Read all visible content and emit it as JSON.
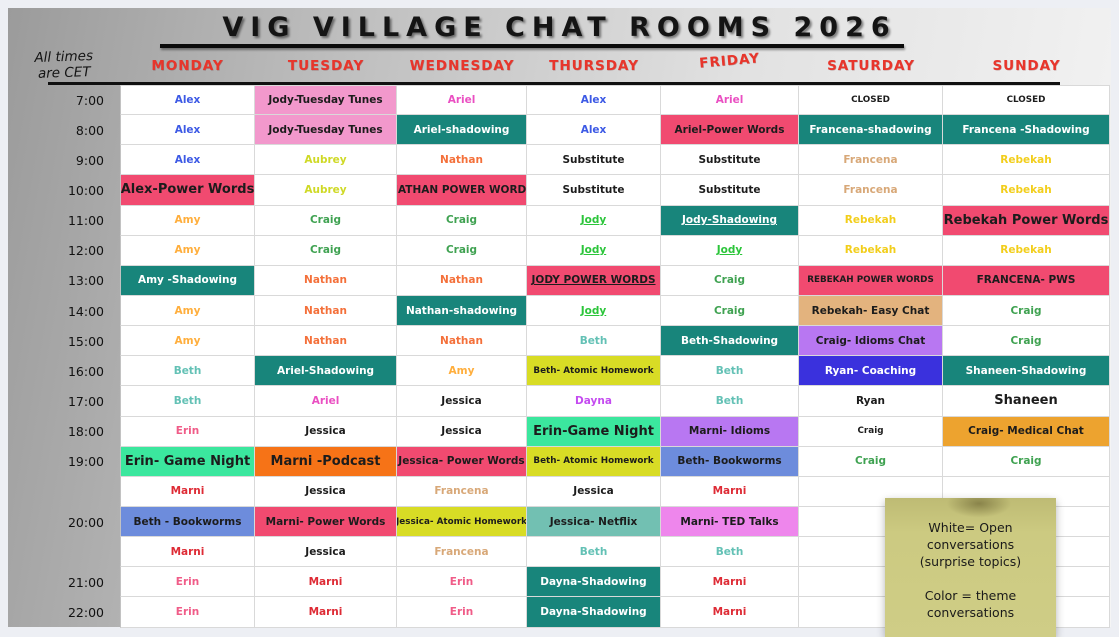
{
  "title": "VIG VILLAGE CHAT ROOMS 2026",
  "subtitle": "All times are CET",
  "days": [
    "MONDAY",
    "TUESDAY",
    "WEDNESDAY",
    "THURSDAY",
    "FRIDAY",
    "SATURDAY",
    "SUNDAY"
  ],
  "legend_note": {
    "lines": [
      "White= Open",
      "conversations",
      "(surprise topics)",
      "",
      "Color = theme",
      "conversations"
    ]
  },
  "palette": {
    "fg": {
      "black": "#1C1C1C",
      "white": "#FFFFFF",
      "blue": "#3D5AE5",
      "amber": "#FFAE3C",
      "orange": "#F4703A",
      "tealName": "#63C1B5",
      "pink": "#F05C88",
      "red": "#DE2B35",
      "chartreuse": "#CFD926",
      "green": "#3FA251",
      "jodyGreen": "#2BC53A",
      "magenta": "#EA4FC2",
      "purple": "#C44BF0",
      "tan": "#D8A878",
      "gold": "#F2CE1B"
    },
    "bg": {
      "white": "#FFFFFF",
      "teal": "#18857B",
      "crimson": "#F14A70",
      "pink": "#F298CC",
      "mint": "#3BE79E",
      "periwinkle": "#6D8CDC",
      "orangeBg": "#F67317",
      "yellow": "#D8DC25",
      "seafoam": "#72C0B2",
      "violet": "#B877F2",
      "orchid": "#EE86EC",
      "tanBg": "#E3B37E",
      "blueBg": "#3A31DD",
      "amberBg": "#EDA32F"
    }
  },
  "rows": [
    {
      "time": "7:00",
      "cells": [
        {
          "t": "Alex",
          "fg": "blue"
        },
        {
          "t": "Jody-Tuesday Tunes",
          "bg": "pink"
        },
        {
          "t": "Ariel",
          "fg": "magenta"
        },
        {
          "t": "Alex",
          "fg": "blue"
        },
        {
          "t": "Ariel",
          "fg": "magenta"
        },
        {
          "t": "CLOSED",
          "sz": "sm"
        },
        {
          "t": "CLOSED",
          "sz": "sm"
        }
      ]
    },
    {
      "time": "8:00",
      "cells": [
        {
          "t": "Alex",
          "fg": "blue"
        },
        {
          "t": "Jody-Tuesday Tunes",
          "bg": "pink"
        },
        {
          "t": "Ariel-shadowing",
          "fg": "white",
          "bg": "teal"
        },
        {
          "t": "Alex",
          "fg": "blue"
        },
        {
          "t": "Ariel-Power Words",
          "bg": "crimson"
        },
        {
          "t": "Francena-shadowing",
          "fg": "white",
          "bg": "teal"
        },
        {
          "t": "Francena -Shadowing",
          "fg": "white",
          "bg": "teal"
        }
      ]
    },
    {
      "time": "9:00",
      "cells": [
        {
          "t": "Alex",
          "fg": "blue"
        },
        {
          "t": "Aubrey",
          "fg": "chartreuse"
        },
        {
          "t": "Nathan",
          "fg": "orange"
        },
        {
          "t": "Substitute"
        },
        {
          "t": "Substitute"
        },
        {
          "t": "Francena",
          "fg": "tan"
        },
        {
          "t": "Rebekah",
          "fg": "gold"
        }
      ]
    },
    {
      "time": "10:00",
      "cells": [
        {
          "t": "Alex-Power Words",
          "bg": "crimson",
          "sz": "lg"
        },
        {
          "t": "Aubrey",
          "fg": "chartreuse"
        },
        {
          "t": "NATHAN POWER WORDS",
          "bg": "crimson"
        },
        {
          "t": "Substitute"
        },
        {
          "t": "Substitute"
        },
        {
          "t": "Francena",
          "fg": "tan"
        },
        {
          "t": "Rebekah",
          "fg": "gold"
        }
      ]
    },
    {
      "time": "11:00",
      "cells": [
        {
          "t": "Amy",
          "fg": "amber"
        },
        {
          "t": "Craig",
          "fg": "green"
        },
        {
          "t": "Craig",
          "fg": "green"
        },
        {
          "t": "Jody",
          "fg": "jodyGreen",
          "u": true
        },
        {
          "t": "Jody-Shadowing",
          "fg": "white",
          "bg": "teal",
          "u": true
        },
        {
          "t": "Rebekah",
          "fg": "gold"
        },
        {
          "t": "Rebekah Power Words",
          "bg": "crimson",
          "sz": "lg"
        }
      ]
    },
    {
      "time": "12:00",
      "cells": [
        {
          "t": "Amy",
          "fg": "amber"
        },
        {
          "t": "Craig",
          "fg": "green"
        },
        {
          "t": "Craig",
          "fg": "green"
        },
        {
          "t": "Jody",
          "fg": "jodyGreen",
          "u": true
        },
        {
          "t": "Jody",
          "fg": "jodyGreen",
          "u": true
        },
        {
          "t": "Rebekah",
          "fg": "gold"
        },
        {
          "t": "Rebekah",
          "fg": "gold"
        }
      ]
    },
    {
      "time": "13:00",
      "cells": [
        {
          "t": "Amy -Shadowing",
          "fg": "white",
          "bg": "teal"
        },
        {
          "t": "Nathan",
          "fg": "orange"
        },
        {
          "t": "Nathan",
          "fg": "orange"
        },
        {
          "t": "JODY POWER WORDS",
          "bg": "crimson",
          "u": true
        },
        {
          "t": "Craig",
          "fg": "green"
        },
        {
          "t": "REBEKAH POWER WORDS",
          "bg": "crimson",
          "sz": "sm"
        },
        {
          "t": "FRANCENA- PWS",
          "bg": "crimson"
        }
      ]
    },
    {
      "time": "14:00",
      "cells": [
        {
          "t": "Amy",
          "fg": "amber"
        },
        {
          "t": "Nathan",
          "fg": "orange"
        },
        {
          "t": "Nathan-shadowing",
          "fg": "white",
          "bg": "teal"
        },
        {
          "t": "Jody",
          "fg": "jodyGreen",
          "u": true
        },
        {
          "t": "Craig",
          "fg": "green"
        },
        {
          "t": "Rebekah- Easy Chat",
          "bg": "tanBg"
        },
        {
          "t": "Craig",
          "fg": "green"
        }
      ]
    },
    {
      "time": "15:00",
      "cells": [
        {
          "t": "Amy",
          "fg": "amber"
        },
        {
          "t": "Nathan",
          "fg": "orange"
        },
        {
          "t": "Nathan",
          "fg": "orange"
        },
        {
          "t": "Beth",
          "fg": "tealName"
        },
        {
          "t": "Beth-Shadowing",
          "fg": "white",
          "bg": "teal"
        },
        {
          "t": "Craig- Idioms Chat",
          "bg": "violet"
        },
        {
          "t": "Craig",
          "fg": "green"
        }
      ]
    },
    {
      "time": "16:00",
      "cells": [
        {
          "t": "Beth",
          "fg": "tealName"
        },
        {
          "t": "Ariel-Shadowing",
          "fg": "white",
          "bg": "teal"
        },
        {
          "t": "Amy",
          "fg": "amber"
        },
        {
          "t": "Beth- Atomic Homework",
          "bg": "yellow",
          "sz": "sm"
        },
        {
          "t": "Beth",
          "fg": "tealName"
        },
        {
          "t": "Ryan- Coaching",
          "fg": "white",
          "bg": "blueBg"
        },
        {
          "t": "Shaneen-Shadowing",
          "fg": "white",
          "bg": "teal"
        }
      ]
    },
    {
      "time": "17:00",
      "cells": [
        {
          "t": "Beth",
          "fg": "tealName"
        },
        {
          "t": "Ariel",
          "fg": "magenta"
        },
        {
          "t": "Jessica"
        },
        {
          "t": "Dayna",
          "fg": "purple"
        },
        {
          "t": "Beth",
          "fg": "tealName"
        },
        {
          "t": "Ryan"
        },
        {
          "t": "Shaneen",
          "sz": "lg"
        }
      ]
    },
    {
      "time": "18:00",
      "cells": [
        {
          "t": "Erin",
          "fg": "pink"
        },
        {
          "t": "Jessica"
        },
        {
          "t": "Jessica"
        },
        {
          "t": "Erin-Game Night",
          "bg": "mint",
          "sz": "lg"
        },
        {
          "t": "Marni- Idioms",
          "bg": "violet"
        },
        {
          "t": "Craig",
          "sz": "sm"
        },
        {
          "t": "Craig- Medical Chat",
          "bg": "amberBg"
        }
      ]
    },
    {
      "time": "19:00",
      "cells": [
        {
          "t": "Erin- Game Night",
          "bg": "mint",
          "sz": "lg"
        },
        {
          "t": "Marni -Podcast",
          "bg": "orangeBg",
          "sz": "lg"
        },
        {
          "t": "Jessica- Power Words",
          "bg": "crimson"
        },
        {
          "t": "Beth- Atomic Homework",
          "bg": "yellow",
          "sz": "sm"
        },
        {
          "t": "Beth- Bookworms",
          "bg": "periwinkle"
        },
        {
          "t": "Craig",
          "fg": "green"
        },
        {
          "t": "Craig",
          "fg": "green"
        }
      ]
    },
    {
      "time": "",
      "cells": [
        {
          "t": "Marni",
          "fg": "red"
        },
        {
          "t": "Jessica"
        },
        {
          "t": "Francena",
          "fg": "tan"
        },
        {
          "t": "Jessica"
        },
        {
          "t": "Marni",
          "fg": "red"
        },
        {
          "t": ""
        },
        {
          "t": ""
        }
      ]
    },
    {
      "time": "20:00",
      "cells": [
        {
          "t": "Beth - Bookworms",
          "bg": "periwinkle"
        },
        {
          "t": "Marni- Power Words",
          "bg": "crimson"
        },
        {
          "t": "Jessica- Atomic Homework",
          "bg": "yellow",
          "sz": "sm"
        },
        {
          "t": "Jessica- Netflix",
          "bg": "seafoam"
        },
        {
          "t": "Marni- TED Talks",
          "bg": "orchid"
        },
        {
          "t": ""
        },
        {
          "t": ""
        }
      ]
    },
    {
      "time": "",
      "cells": [
        {
          "t": "Marni",
          "fg": "red"
        },
        {
          "t": "Jessica"
        },
        {
          "t": "Francena",
          "fg": "tan"
        },
        {
          "t": "Beth",
          "fg": "tealName"
        },
        {
          "t": "Beth",
          "fg": "tealName"
        },
        {
          "t": ""
        },
        {
          "t": ""
        }
      ]
    },
    {
      "time": "21:00",
      "cells": [
        {
          "t": "Erin",
          "fg": "pink"
        },
        {
          "t": "Marni",
          "fg": "red"
        },
        {
          "t": "Erin",
          "fg": "pink"
        },
        {
          "t": "Dayna-Shadowing",
          "fg": "white",
          "bg": "teal"
        },
        {
          "t": "Marni",
          "fg": "red"
        },
        {
          "t": ""
        },
        {
          "t": ""
        }
      ]
    },
    {
      "time": "22:00",
      "cells": [
        {
          "t": "Erin",
          "fg": "pink"
        },
        {
          "t": "Marni",
          "fg": "red"
        },
        {
          "t": "Erin",
          "fg": "pink"
        },
        {
          "t": "Dayna-Shadowing",
          "fg": "white",
          "bg": "teal"
        },
        {
          "t": "Marni",
          "fg": "red"
        },
        {
          "t": ""
        },
        {
          "t": ""
        }
      ]
    }
  ]
}
